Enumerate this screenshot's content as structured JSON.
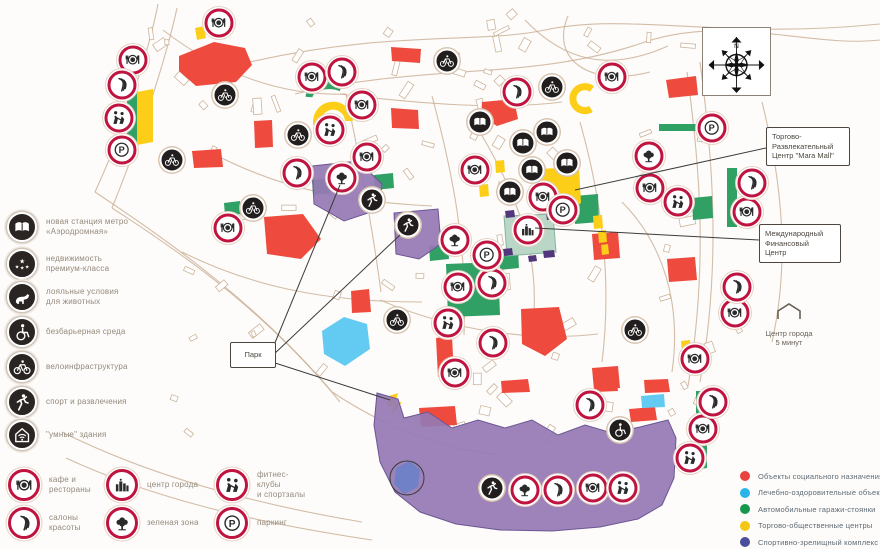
{
  "left_legend": {
    "items": [
      {
        "icon": "metro",
        "label": "новая станция метро\n«Аэродромная»"
      },
      {
        "icon": "stars",
        "label": "недвижимость\nпремиум-класса"
      },
      {
        "icon": "dog",
        "label": "лояльные условия\nдля животных"
      },
      {
        "icon": "wheelchair",
        "label": "безбарьерная среда"
      },
      {
        "icon": "bike",
        "label": "велоинфраструктура"
      },
      {
        "icon": "sport",
        "label": "спорт и развлечения"
      },
      {
        "icon": "smart",
        "label": "\"умные\" здания"
      }
    ]
  },
  "bottom_legend": {
    "items": [
      {
        "icon": "restaurant",
        "label": "кафе и рестораны",
        "col": 0,
        "row": 0
      },
      {
        "icon": "salon",
        "label": "салоны красоты",
        "col": 0,
        "row": 1
      },
      {
        "icon": "city",
        "label": "центр города",
        "col": 1,
        "row": 0
      },
      {
        "icon": "tree",
        "label": "зеленая зона",
        "col": 1,
        "row": 1
      },
      {
        "icon": "fitness",
        "label": "фитнес-клубы\nи спортзалы",
        "col": 2,
        "row": 0
      },
      {
        "icon": "parking",
        "label": "паркинг",
        "col": 2,
        "row": 1
      }
    ]
  },
  "color_legend": {
    "items": [
      {
        "color": "#e8413e",
        "label": "Объекты социального назначения"
      },
      {
        "color": "#29b5e8",
        "label": "Лечебно-оздоровительные объекты"
      },
      {
        "color": "#17984f",
        "label": "Автомобильные гаражи-стоянки"
      },
      {
        "color": "#f3c713",
        "label": "Торгово-общественные центры"
      },
      {
        "color": "#4a4e9c",
        "label": "Спортивно-зрелищный комплекс"
      }
    ]
  },
  "callouts": {
    "park": "Парк",
    "mall": "Торгово-\nРазвлекательный\nЦентр \"Mara Mall\"",
    "financial": "Международный\nФинансовый\nЦентр",
    "city_center": "Центр города\n5 минут",
    "compass_n": "N"
  },
  "map": {
    "icons": [
      {
        "type": "restaurant",
        "x": 219,
        "y": 23
      },
      {
        "type": "restaurant",
        "x": 133,
        "y": 60
      },
      {
        "type": "restaurant",
        "x": 312,
        "y": 77
      },
      {
        "type": "restaurant",
        "x": 612,
        "y": 77
      },
      {
        "type": "restaurant",
        "x": 362,
        "y": 105
      },
      {
        "type": "restaurant",
        "x": 367,
        "y": 157
      },
      {
        "type": "restaurant",
        "x": 228,
        "y": 228
      },
      {
        "type": "restaurant",
        "x": 475,
        "y": 170
      },
      {
        "type": "restaurant",
        "x": 543,
        "y": 197
      },
      {
        "type": "restaurant",
        "x": 650,
        "y": 188
      },
      {
        "type": "restaurant",
        "x": 747,
        "y": 212
      },
      {
        "type": "restaurant",
        "x": 458,
        "y": 287
      },
      {
        "type": "restaurant",
        "x": 735,
        "y": 313
      },
      {
        "type": "restaurant",
        "x": 695,
        "y": 359
      },
      {
        "type": "restaurant",
        "x": 455,
        "y": 373
      },
      {
        "type": "restaurant",
        "x": 703,
        "y": 429
      },
      {
        "type": "restaurant",
        "x": 593,
        "y": 488
      },
      {
        "type": "salon",
        "x": 122,
        "y": 85
      },
      {
        "type": "salon",
        "x": 342,
        "y": 72
      },
      {
        "type": "salon",
        "x": 517,
        "y": 92
      },
      {
        "type": "salon",
        "x": 297,
        "y": 173
      },
      {
        "type": "salon",
        "x": 752,
        "y": 183
      },
      {
        "type": "salon",
        "x": 492,
        "y": 283
      },
      {
        "type": "salon",
        "x": 737,
        "y": 287
      },
      {
        "type": "salon",
        "x": 493,
        "y": 343
      },
      {
        "type": "salon",
        "x": 590,
        "y": 405
      },
      {
        "type": "salon",
        "x": 713,
        "y": 402
      },
      {
        "type": "salon",
        "x": 558,
        "y": 490
      },
      {
        "type": "fitness",
        "x": 119,
        "y": 118
      },
      {
        "type": "fitness",
        "x": 330,
        "y": 130
      },
      {
        "type": "fitness",
        "x": 678,
        "y": 202
      },
      {
        "type": "fitness",
        "x": 448,
        "y": 323
      },
      {
        "type": "fitness",
        "x": 690,
        "y": 458
      },
      {
        "type": "fitness",
        "x": 623,
        "y": 488
      },
      {
        "type": "parking",
        "x": 122,
        "y": 150
      },
      {
        "type": "parking",
        "x": 712,
        "y": 128
      },
      {
        "type": "parking",
        "x": 563,
        "y": 210
      },
      {
        "type": "parking",
        "x": 487,
        "y": 255
      },
      {
        "type": "tree",
        "x": 342,
        "y": 178
      },
      {
        "type": "tree",
        "x": 455,
        "y": 240
      },
      {
        "type": "tree",
        "x": 649,
        "y": 156
      },
      {
        "type": "tree",
        "x": 525,
        "y": 490
      },
      {
        "type": "city",
        "x": 528,
        "y": 230
      },
      {
        "type": "metro",
        "x": 480,
        "y": 122
      },
      {
        "type": "metro",
        "x": 523,
        "y": 143
      },
      {
        "type": "metro",
        "x": 547,
        "y": 132
      },
      {
        "type": "metro",
        "x": 532,
        "y": 170
      },
      {
        "type": "metro",
        "x": 567,
        "y": 163
      },
      {
        "type": "metro",
        "x": 510,
        "y": 192
      },
      {
        "type": "bike",
        "x": 447,
        "y": 61
      },
      {
        "type": "bike",
        "x": 552,
        "y": 87
      },
      {
        "type": "bike",
        "x": 225,
        "y": 95
      },
      {
        "type": "bike",
        "x": 298,
        "y": 135
      },
      {
        "type": "bike",
        "x": 172,
        "y": 160
      },
      {
        "type": "bike",
        "x": 253,
        "y": 208
      },
      {
        "type": "bike",
        "x": 397,
        "y": 320
      },
      {
        "type": "bike",
        "x": 635,
        "y": 330
      },
      {
        "type": "sport",
        "x": 372,
        "y": 200
      },
      {
        "type": "sport",
        "x": 408,
        "y": 225
      },
      {
        "type": "sport",
        "x": 492,
        "y": 488
      },
      {
        "type": "wheelchair",
        "x": 620,
        "y": 430
      }
    ],
    "shapes": [
      {
        "c": "red",
        "pts": "179,56 214,42 245,48 252,65 236,82 196,86 179,71"
      },
      {
        "c": "red",
        "pts": "391,47 421,49 420,63 392,61"
      },
      {
        "c": "red",
        "pts": "482,102 514,99 518,119 497,126 481,116"
      },
      {
        "c": "red",
        "pts": "666,80 696,76 698,95 669,98"
      },
      {
        "c": "red",
        "pts": "391,108 418,110 419,129 392,128"
      },
      {
        "c": "red",
        "pts": "254,121 272,120 273,147 255,148"
      },
      {
        "c": "red",
        "pts": "192,151 221,149 223,167 194,168"
      },
      {
        "c": "red",
        "pts": "264,217 303,214 321,239 301,259 267,254"
      },
      {
        "c": "red",
        "pts": "351,291 369,289 371,312 352,313"
      },
      {
        "c": "red",
        "pts": "592,234 618,232 620,258 594,260"
      },
      {
        "c": "red",
        "pts": "667,259 695,257 697,280 669,282"
      },
      {
        "c": "red",
        "pts": "521,309 559,307 567,339 545,356 522,344"
      },
      {
        "c": "red",
        "pts": "436,338 452,336 454,375 438,377"
      },
      {
        "c": "red",
        "pts": "592,368 618,366 620,388 594,390"
      },
      {
        "c": "red",
        "pts": "419,408 455,406 457,425 421,427"
      },
      {
        "c": "red",
        "pts": "501,381 528,379 530,392 502,393"
      },
      {
        "c": "red",
        "pts": "594,380 616,379 618,391 595,392"
      },
      {
        "c": "red",
        "pts": "644,380 668,379 670,392 645,393"
      },
      {
        "c": "red",
        "pts": "629,409 655,407 657,420 631,422"
      },
      {
        "c": "cyan",
        "pts": "322,331 344,317 367,324 370,349 345,366 324,354"
      },
      {
        "c": "cyan",
        "pts": "641,396 664,394 665,407 642,408"
      },
      {
        "c": "green",
        "pts": "127,97 140,92 140,143 127,148"
      },
      {
        "c": "green",
        "pts": "224,203 240,201 241,214 225,216"
      },
      {
        "c": "green",
        "pts": "692,198 712,196 713,218 693,220"
      },
      {
        "c": "green",
        "pts": "727,168 737,168 737,227 727,227"
      },
      {
        "c": "green",
        "pts": "659,124 700,124 700,131 659,131"
      },
      {
        "c": "green",
        "pts": "696,391 707,391 707,468 696,470"
      },
      {
        "c": "green",
        "pts": "446,264 498,262 500,315 448,317"
      },
      {
        "c": "green",
        "pts": "312,180 330,178 331,193 313,195"
      },
      {
        "c": "green",
        "pts": "374,175 393,173 394,188 375,190"
      },
      {
        "c": "green",
        "pts": "429,246 448,244 449,259 430,261"
      },
      {
        "c": "green",
        "pts": "574,196 598,194 599,222 575,224"
      },
      {
        "c": "green",
        "pts": "499,251 518,249 519,268 500,270"
      },
      {
        "c": "green",
        "arc": "M309,97 A20,12 0 0 1 341,88",
        "w": 7
      },
      {
        "c": "yellow",
        "pts": "137,92 153,89 153,142 137,145"
      },
      {
        "c": "yellow",
        "pts": "195,28 204,26 206,38 197,40"
      },
      {
        "c": "yellow",
        "pts": "539,169 579,167 581,203 566,214 541,211"
      },
      {
        "c": "yellow",
        "pts": "593,216 602,215 603,228 594,229"
      },
      {
        "c": "yellow",
        "pts": "598,231 606,230 607,242 599,243"
      },
      {
        "c": "yellow",
        "pts": "601,245 608,244 609,254 602,255"
      },
      {
        "c": "yellow",
        "pts": "681,341 690,340 691,351 682,352"
      },
      {
        "c": "yellow",
        "pts": "389,396 398,393 395,403 402,402 391,416 394,405 387,407"
      },
      {
        "c": "yellow",
        "pts": "479,185 488,184 489,196 480,197"
      },
      {
        "c": "yellow",
        "pts": "495,161 504,160 505,172 496,173"
      },
      {
        "c": "yellow",
        "arc": "M320,131 A16,16 0 1 1 349,121",
        "w": 8
      },
      {
        "c": "yellow",
        "arc": "M592,89 A12,12 0 1 0 591,109",
        "w": 7
      },
      {
        "c": "purple",
        "pts": "312,166 358,161 382,184 380,209 344,221 314,204"
      },
      {
        "c": "purple",
        "pts": "394,213 438,209 441,244 419,259 396,254"
      },
      {
        "c": "purple",
        "pts": "377,393 398,399 404,418 428,412 452,428 478,420 505,428 532,420 558,435 585,425 612,433 640,427 668,420 676,438 674,478 662,505 638,519 600,527 552,531 500,530 456,524 420,512 395,492 380,462 374,425"
      },
      {
        "c": "teal",
        "pts": "504,216 553,214 556,252 507,256"
      },
      {
        "c": "darkpurple",
        "pts": "505,211 514,210 515,217 506,218"
      },
      {
        "c": "darkpurple",
        "pts": "546,213 555,212 556,219 547,220"
      },
      {
        "c": "darkpurple",
        "pts": "503,249 512,248 513,255 504,256"
      },
      {
        "c": "darkpurple",
        "pts": "543,251 554,250 555,257 544,258"
      },
      {
        "c": "darkpurple",
        "pts": "528,256 536,255 537,261 529,262"
      },
      {
        "c": "lake",
        "pts": "396,468 410,461 420,470 418,487 404,494 394,484"
      }
    ],
    "callout_lines": [
      {
        "x1": 272,
        "y1": 350,
        "x2": 340,
        "y2": 185
      },
      {
        "x1": 272,
        "y1": 356,
        "x2": 400,
        "y2": 235
      },
      {
        "x1": 272,
        "y1": 362,
        "x2": 390,
        "y2": 400
      },
      {
        "x1": 766,
        "y1": 148,
        "x2": 575,
        "y2": 190
      },
      {
        "x1": 759,
        "y1": 240,
        "x2": 535,
        "y2": 228
      }
    ]
  }
}
